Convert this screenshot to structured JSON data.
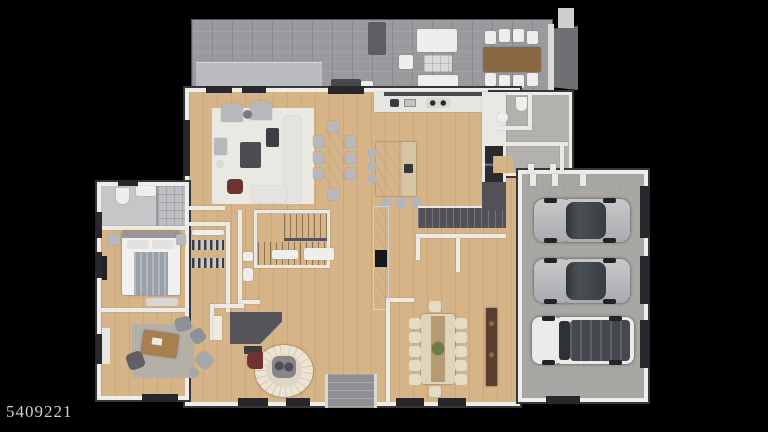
{
  "watermark": {
    "text": "5409221"
  },
  "palette": {
    "background": "#000000",
    "wood_floor": "#d6b488",
    "patio_paver": "#9a9a9e",
    "concrete_band": "#bcbcc0",
    "garage_floor": "#a7a6a3",
    "wall_white": "#eeede9",
    "wall_edge_dark": "#37373a",
    "tile_gray": "#c6c6c9",
    "mudroom_gray": "#b3b1ae",
    "marble_white": "#f4f3f1",
    "dark_charcoal": "#4a4a4f",
    "accent_maroon": "#6e3230",
    "desk_wood": "#a97f50",
    "outdoor_table_wood": "#8a6844",
    "sideboard_brown": "#5a3f2f",
    "dining_cream": "#ded3bb",
    "stair_carpet_cream": "#e7ded0",
    "car_silver": "#b9bbbd",
    "car_glass": "#3c4146",
    "suv_white": "#ebebec",
    "plant_green": "#6d7c4a"
  },
  "scene": {
    "kind": "3d-rendered-floor-plan",
    "rooms": [
      "patio-deck",
      "living-room",
      "breakfast-dining-area",
      "kitchen",
      "stair-hall",
      "bathroom",
      "bedroom",
      "walk-in-closet",
      "office",
      "music-room-foyer",
      "formal-dining-room",
      "mudroom",
      "garage"
    ],
    "vehicles": [
      "silver-sedan",
      "silver-sedan",
      "white-suv"
    ],
    "garage_door_count": 3
  }
}
